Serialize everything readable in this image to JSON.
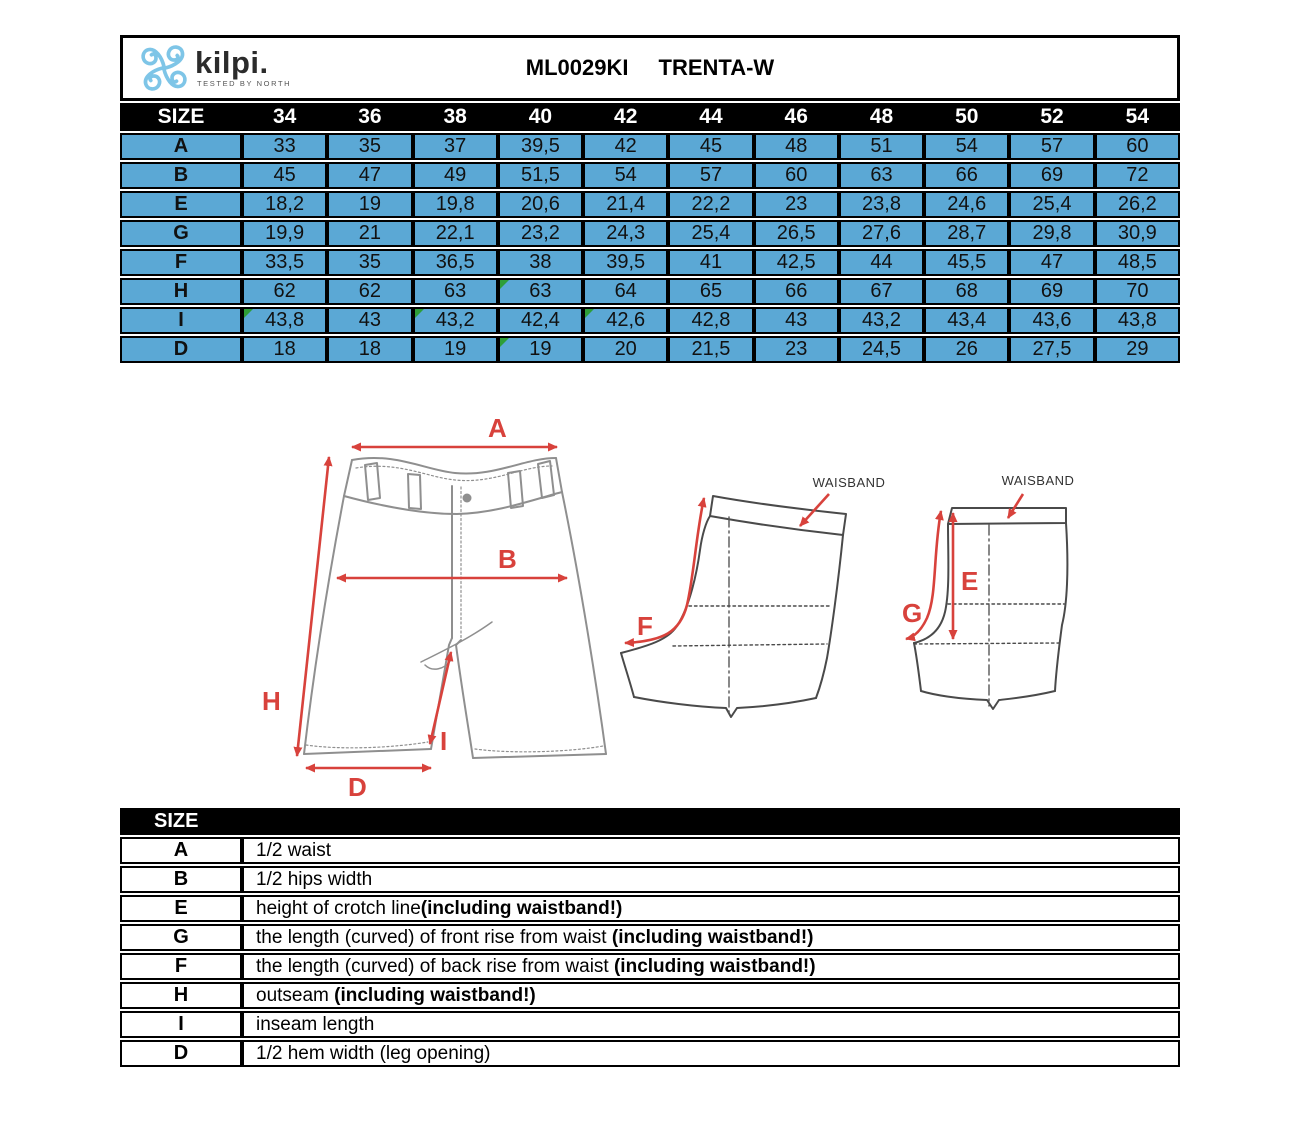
{
  "header": {
    "brand": "kilpi.",
    "brand_tagline": "TESTED BY NORTH",
    "product_code": "ML0029KI",
    "product_name": "TRENTA-W"
  },
  "colors": {
    "cell_blue": "#5BA8D5",
    "header_black": "#000000",
    "arrow_red": "#D8423C",
    "marker_green": "#2E9E38",
    "logo_blue": "#7EC5E7"
  },
  "size_table": {
    "corner_label": "SIZE",
    "sizes": [
      "34",
      "36",
      "38",
      "40",
      "42",
      "44",
      "46",
      "48",
      "50",
      "52",
      "54"
    ],
    "rows": [
      {
        "label": "A",
        "values": [
          "33",
          "35",
          "37",
          "39,5",
          "42",
          "45",
          "48",
          "51",
          "54",
          "57",
          "60"
        ],
        "markers": []
      },
      {
        "label": "B",
        "values": [
          "45",
          "47",
          "49",
          "51,5",
          "54",
          "57",
          "60",
          "63",
          "66",
          "69",
          "72"
        ],
        "markers": []
      },
      {
        "label": "E",
        "values": [
          "18,2",
          "19",
          "19,8",
          "20,6",
          "21,4",
          "22,2",
          "23",
          "23,8",
          "24,6",
          "25,4",
          "26,2"
        ],
        "markers": []
      },
      {
        "label": "G",
        "values": [
          "19,9",
          "21",
          "22,1",
          "23,2",
          "24,3",
          "25,4",
          "26,5",
          "27,6",
          "28,7",
          "29,8",
          "30,9"
        ],
        "markers": []
      },
      {
        "label": "F",
        "values": [
          "33,5",
          "35",
          "36,5",
          "38",
          "39,5",
          "41",
          "42,5",
          "44",
          "45,5",
          "47",
          "48,5"
        ],
        "markers": []
      },
      {
        "label": "H",
        "values": [
          "62",
          "62",
          "63",
          "63",
          "64",
          "65",
          "66",
          "67",
          "68",
          "69",
          "70"
        ],
        "markers": [
          3
        ]
      },
      {
        "label": "I",
        "values": [
          "43,8",
          "43",
          "43,2",
          "42,4",
          "42,6",
          "42,8",
          "43",
          "43,2",
          "43,4",
          "43,6",
          "43,8"
        ],
        "markers": [
          0,
          2,
          4
        ]
      },
      {
        "label": "D",
        "values": [
          "18",
          "18",
          "19",
          "19",
          "20",
          "21,5",
          "23",
          "24,5",
          "26",
          "27,5",
          "29"
        ],
        "markers": [
          3
        ]
      }
    ]
  },
  "diagram": {
    "waistband_label": "WAISBAND",
    "letters": {
      "A": "A",
      "B": "B",
      "D": "D",
      "E": "E",
      "F": "F",
      "G": "G",
      "H": "H",
      "I": "I"
    }
  },
  "legend_table": {
    "header": "SIZE",
    "rows": [
      {
        "label": "A",
        "text": "1/2 waist",
        "bold": ""
      },
      {
        "label": "B",
        "text": "1/2 hips width",
        "bold": ""
      },
      {
        "label": "E",
        "text": "height of crotch line",
        "bold": "(including waistband!)"
      },
      {
        "label": "G",
        "text": "the length (curved) of front rise from waist ",
        "bold": "(including waistband!)"
      },
      {
        "label": "F",
        "text": "the length (curved) of back rise from waist ",
        "bold": "(including waistband!)"
      },
      {
        "label": "H",
        "text": "outseam  ",
        "bold": "(including waistband!)"
      },
      {
        "label": "I",
        "text": "inseam length",
        "bold": ""
      },
      {
        "label": "D",
        "text": "1/2 hem width (leg opening)",
        "bold": ""
      }
    ]
  }
}
